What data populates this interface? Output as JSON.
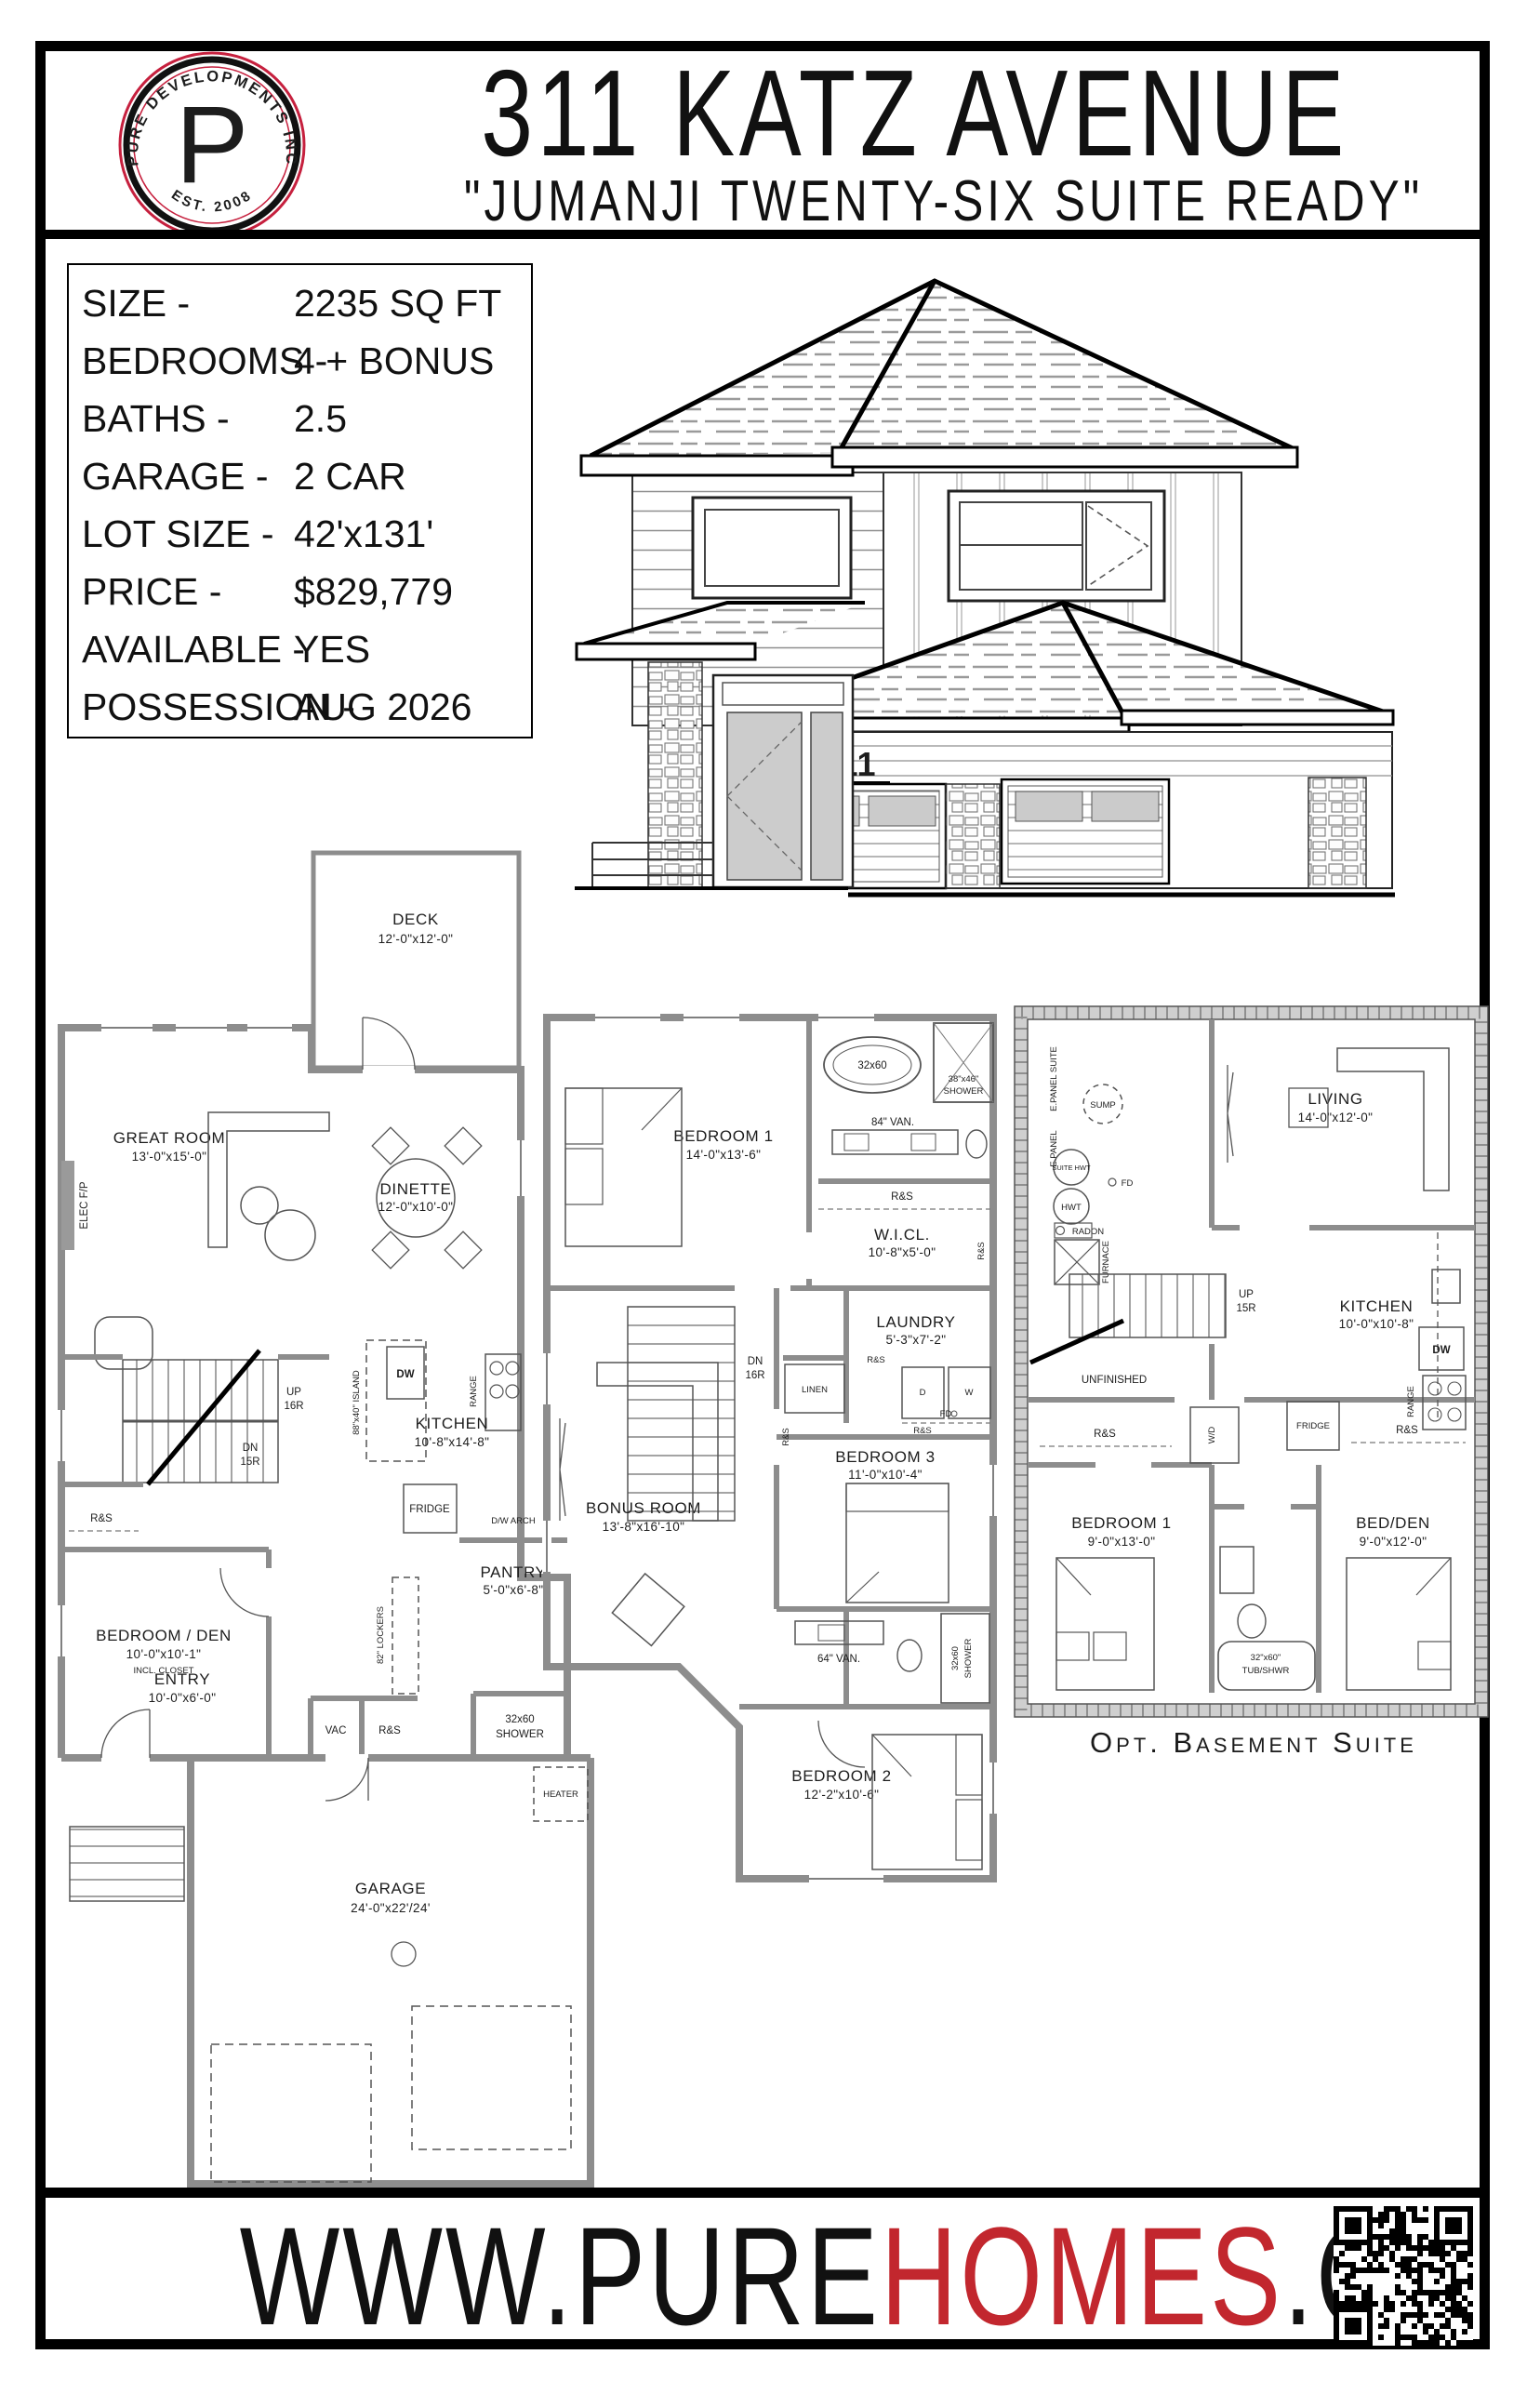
{
  "header": {
    "logo": {
      "ring_text": "PURE DEVELOPMENTS INC",
      "letter": "P",
      "est": "EST. 2008"
    },
    "title": "311 KATZ AVENUE",
    "subtitle": "\"JUMANJI TWENTY-SIX SUITE READY\""
  },
  "specs": {
    "rows": [
      {
        "label": "SIZE -",
        "value": "2235 SQ FT"
      },
      {
        "label": "BEDROOMS -",
        "value": "4 + BONUS"
      },
      {
        "label": "BATHS -",
        "value": "2.5"
      },
      {
        "label": "GARAGE -",
        "value": "2 CAR"
      },
      {
        "label": "LOT SIZE -",
        "value": "42'x131'"
      },
      {
        "label": "PRICE -",
        "value": "$829,779"
      },
      {
        "label": "AVAILABLE -",
        "value": "YES"
      },
      {
        "label": "POSSESSION -",
        "value": "AUG 2026"
      }
    ]
  },
  "elevation": {
    "house_number": "311"
  },
  "plans": {
    "shared": {
      "rs": "R&S",
      "dw": "DW",
      "range": "RANGE",
      "fridge": "FRIDGE",
      "shower_size": "32x60",
      "shower": "SHOWER",
      "up": "UP",
      "dn": "DN"
    },
    "main": {
      "deck": {
        "name": "DECK",
        "dims": "12'-0\"x12'-0\""
      },
      "great_room": {
        "name": "GREAT ROOM",
        "dims": "13'-0\"x15'-0\""
      },
      "elec_fp": "ELEC F/P",
      "dinette": {
        "name": "DINETTE",
        "dims": "12'-0\"x10'-0\""
      },
      "island": "88\"x40\" ISLAND",
      "kitchen": {
        "name": "KITCHEN",
        "dims": "10'-8\"x14'-8\""
      },
      "up_risers": "16R",
      "dn_risers": "15R",
      "bedroom_den": {
        "name": "BEDROOM / DEN",
        "dims": "10'-0\"x10'-1\"",
        "note": "INCL. CLOSET"
      },
      "dw_arch": "D/W ARCH",
      "pantry": {
        "name": "PANTRY",
        "dims": "5'-0\"x6'-8\""
      },
      "lockers": "82\" LOCKERS",
      "entry": {
        "name": "ENTRY",
        "dims": "10'-0\"x6'-0\""
      },
      "vac": "VAC",
      "heater": "HEATER",
      "garage": {
        "name": "GARAGE",
        "dims": "24'-0\"x22'/24'"
      }
    },
    "upper": {
      "bedroom1": {
        "name": "BEDROOM 1",
        "dims": "14'-0\"x13'-6\""
      },
      "tub": "32x60",
      "shower38": "38\"x46\"",
      "van84": "84\" VAN.",
      "wicl": {
        "name": "W.I.CL.",
        "dims": "10'-8\"x5'-0\""
      },
      "laundry": {
        "name": "LAUNDRY",
        "dims": "5'-3\"x7'-2\""
      },
      "linen": "LINEN",
      "d": "D",
      "w": "W",
      "fd": "FD",
      "dn_risers": "16R",
      "bedroom3": {
        "name": "BEDROOM 3",
        "dims": "11'-0\"x10'-4\""
      },
      "van64": "64\" VAN.",
      "bonus": {
        "name": "BONUS ROOM",
        "dims": "13'-8\"x16'-10\""
      },
      "bedroom2": {
        "name": "BEDROOM 2",
        "dims": "12'-2\"x10'-6\""
      }
    },
    "basement": {
      "epanel_suite": "E.PANEL SUITE",
      "epanel": "E.PANEL",
      "sump": "SUMP",
      "suite_hwt": "SUITE HWT",
      "hwt": "HWT",
      "fd": "FD",
      "radon": "RADON",
      "furnace": "FURNACE",
      "living": {
        "name": "LIVING",
        "dims": "14'-0\"x12'-0\""
      },
      "up_risers": "15R",
      "unfinished": "UNFINISHED",
      "kitchen": {
        "name": "KITCHEN",
        "dims": "10'-0\"x10'-8\""
      },
      "wd": "W/D",
      "bedroom1": {
        "name": "BEDROOM 1",
        "dims": "9'-0\"x13'-0\""
      },
      "bedden": {
        "name": "BED/DEN",
        "dims": "9'-0\"x12'-0\""
      },
      "tub": {
        "size": "32\"x60\"",
        "label": "TUB/SHWR"
      },
      "caption": "Opt. Basement Suite"
    }
  },
  "footer": {
    "url_prefix": "WWW.PURE",
    "url_accent": "HOMES",
    "url_suffix": ".CA"
  },
  "colors": {
    "accent_red": "#c2272e",
    "logo_red": "#c6203e"
  }
}
